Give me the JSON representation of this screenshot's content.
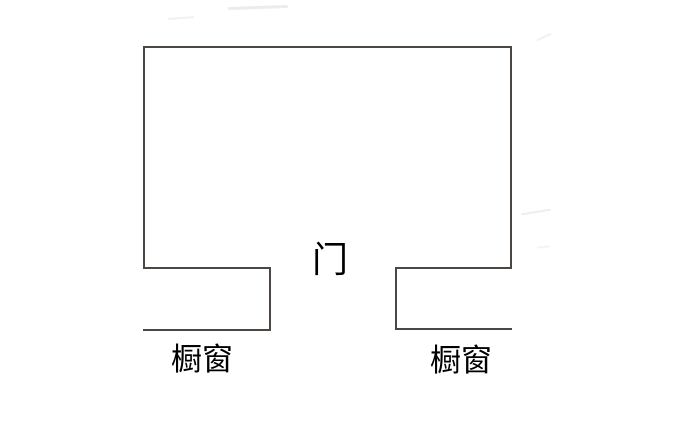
{
  "figure": {
    "type": "floor-plan-sketch",
    "labels": {
      "door": "门",
      "left_showcase": "橱窗",
      "right_showcase": "橱窗"
    },
    "colors": {
      "wall": "#4c4743",
      "text": "#000000",
      "background": "#ffffff"
    }
  }
}
